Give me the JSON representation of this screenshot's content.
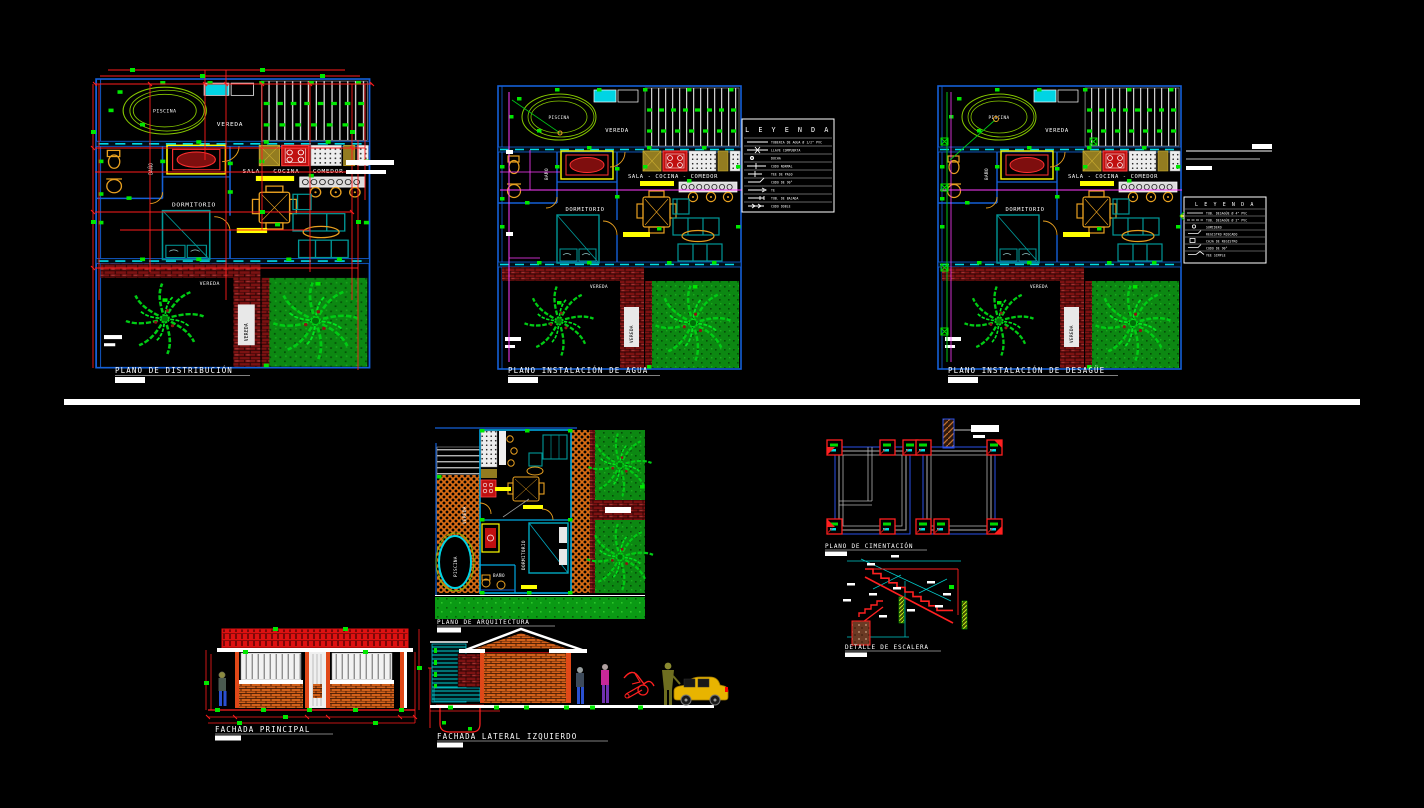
{
  "sheet": {
    "background": "#000000",
    "divider_color": "#ffffff"
  },
  "colors": {
    "dimension_red": "#ff1c1c",
    "wall_blue": "#1460d8",
    "wall_cyan": "#00dce8",
    "grip_green": "#00e800",
    "vegetation_green": "#00cc14",
    "water_magenta": "#ff3cff",
    "furniture_orange": "#e8a020",
    "furniture_teal": "#009898",
    "brick_dark": "#7c1212",
    "brick_orange": "#d2601a",
    "highlight_yellow": "#ffff00"
  },
  "titles": {
    "distribucion": "PLANO DE DISTRIBUCIÓN",
    "agua": "PLANO INSTALACIÓN DE AGUA",
    "desague": "PLANO INSTALACIÓN DE DESAGÜE",
    "arquitectura": "PLANO DE ARQUITECTURA",
    "cimentacion": "PLANO DE CIMENTACIÓN",
    "escalera": "DETALLE DE ESCALERA",
    "fachada_principal": "FACHADA PRINCIPAL",
    "fachada_lateral": "FACHADA LATERAL IZQUIERDO"
  },
  "floorplan": {
    "labels": {
      "piscina": "PISCINA",
      "vereda": "VEREDA",
      "sala": "SALA - COCINA - COMEDOR",
      "dormitorio": "DORMITORIO",
      "bano": "BAÑO",
      "vereda_vertical": "VEREDA",
      "vereda_baja": "VEREDA"
    }
  },
  "arquitectura": {
    "labels": {
      "piscina": "PISCINA",
      "vereda": "VEREDA",
      "dormitorio": "DORMITORIO",
      "bano": "BAÑO"
    }
  },
  "leyenda_agua": {
    "title": "L E Y E N D A",
    "rows": [
      "TUBERIA DE AGUA Ø 1/2\" PVC",
      "LLAVE COMPUERTA",
      "DUCHA",
      "CODO NORMAL",
      "TEE DE PASO",
      "CODO DE 90°",
      "TE",
      "TUB. DE BAJADA",
      "CODO DOBLE"
    ]
  },
  "leyenda_desague": {
    "title": "L E Y E N D A",
    "rows": [
      "TUB. DESAGÜE Ø 4\" PVC",
      "TUB. DESAGÜE Ø 2\" PVC",
      "SUMIDERO",
      "REGISTRO ROSCADO",
      "CAJA DE REGISTRO",
      "CODO DE 90°",
      "YEE SIMPLE"
    ]
  }
}
